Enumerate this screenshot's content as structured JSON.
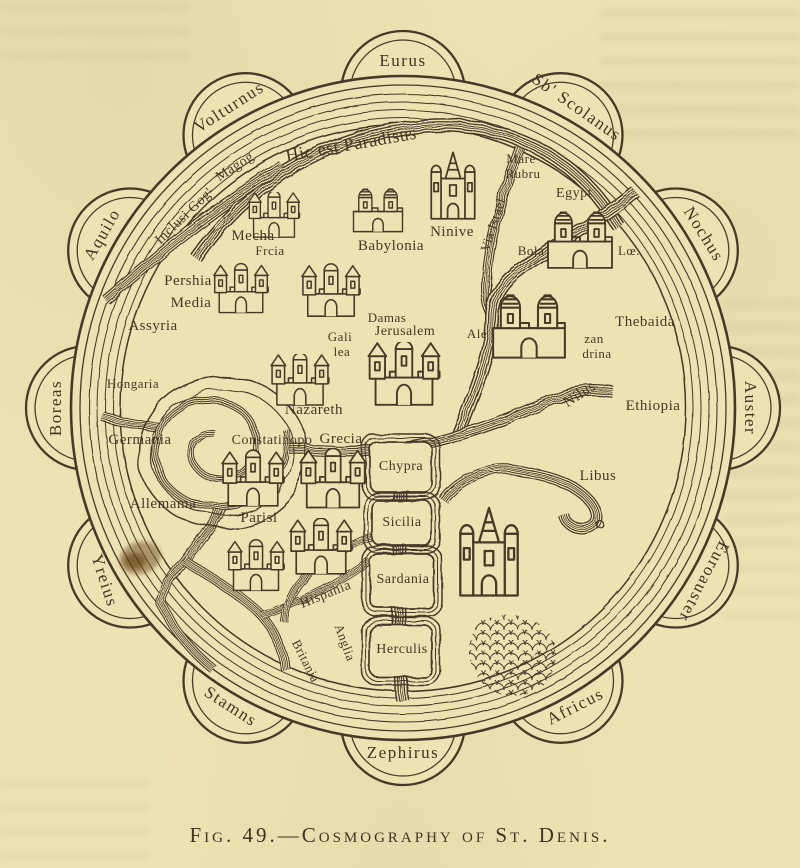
{
  "figure": {
    "caption": "Fig. 49.—Cosmography of St. Denis."
  },
  "colors": {
    "paper": "#ece3b2",
    "ink": "#46392a",
    "stain": "#6d4b1d"
  },
  "winds": [
    {
      "name": "Eurus",
      "angle": 0,
      "rot": 0
    },
    {
      "name": "Sb' Scolanus",
      "angle": 30,
      "rot": 35
    },
    {
      "name": "Nochus",
      "angle": 60,
      "rot": 58
    },
    {
      "name": "Auster",
      "angle": 90,
      "rot": 90
    },
    {
      "name": "Euroauster",
      "angle": 120,
      "rot": 118
    },
    {
      "name": "Africus",
      "angle": 150,
      "rot": -27
    },
    {
      "name": "Zephirus",
      "angle": 180,
      "rot": 0
    },
    {
      "name": "Stamns",
      "angle": 210,
      "rot": 33
    },
    {
      "name": "Yreius",
      "angle": 240,
      "rot": 72
    },
    {
      "name": "Boreas",
      "angle": 270,
      "rot": -90
    },
    {
      "name": "Aquilo",
      "angle": 300,
      "rot": -60
    },
    {
      "name": "Volturnus",
      "angle": 330,
      "rot": -33
    }
  ],
  "labels": [
    {
      "text": "Hic est Paradisus",
      "x": 352,
      "y": 150,
      "rot": -10,
      "size": 18
    },
    {
      "text": "Magog",
      "x": 237,
      "y": 170,
      "rot": -33,
      "size": 14
    },
    {
      "text": "Inclusi Gog'",
      "x": 187,
      "y": 219,
      "rot": -44,
      "size": 14
    },
    {
      "text": "Mecha",
      "x": 253,
      "y": 240,
      "rot": 0,
      "size": 15
    },
    {
      "text": "Frcia",
      "x": 270,
      "y": 255,
      "rot": 0,
      "size": 13
    },
    {
      "text": "Babylonia",
      "x": 391,
      "y": 250,
      "rot": 0,
      "size": 15
    },
    {
      "text": "Ninive",
      "x": 452,
      "y": 236,
      "rot": 0,
      "size": 15
    },
    {
      "text": "Pershia",
      "x": 188,
      "y": 285,
      "rot": 0,
      "size": 15
    },
    {
      "text": "Media",
      "x": 191,
      "y": 307,
      "rot": 0,
      "size": 15
    },
    {
      "text": "Assyria",
      "x": 153,
      "y": 330,
      "rot": 0,
      "size": 15
    },
    {
      "text": "Hongaria",
      "x": 133,
      "y": 388,
      "rot": 0,
      "size": 13
    },
    {
      "text": "Germania",
      "x": 140,
      "y": 444,
      "rot": 0,
      "size": 15
    },
    {
      "text": "Allemama",
      "x": 163,
      "y": 508,
      "rot": 0,
      "size": 15
    },
    {
      "text": "Damas",
      "x": 387,
      "y": 322,
      "rot": 0,
      "size": 13
    },
    {
      "text": "Jerusalem",
      "x": 405,
      "y": 335,
      "rot": 0,
      "size": 14
    },
    {
      "text": "Gali",
      "x": 340,
      "y": 341,
      "rot": 0,
      "size": 13
    },
    {
      "text": "lea",
      "x": 342,
      "y": 356,
      "rot": 0,
      "size": 13
    },
    {
      "text": "Nazareth",
      "x": 314,
      "y": 414,
      "rot": 0,
      "size": 15
    },
    {
      "text": "Mare",
      "x": 521,
      "y": 163,
      "rot": 0,
      "size": 13
    },
    {
      "text": "Rubru",
      "x": 523,
      "y": 178,
      "rot": 0,
      "size": 13
    },
    {
      "text": "Via Israel",
      "x": 497,
      "y": 226,
      "rot": -72,
      "size": 13
    },
    {
      "text": "Egypt",
      "x": 574,
      "y": 197,
      "rot": 0,
      "size": 14
    },
    {
      "text": "Bola",
      "x": 531,
      "y": 255,
      "rot": 0,
      "size": 13
    },
    {
      "text": "Lœ.",
      "x": 629,
      "y": 255,
      "rot": 0,
      "size": 13
    },
    {
      "text": "Ale",
      "x": 477,
      "y": 338,
      "rot": 0,
      "size": 13
    },
    {
      "text": "zan",
      "x": 594,
      "y": 343,
      "rot": 0,
      "size": 13
    },
    {
      "text": "drina",
      "x": 597,
      "y": 358,
      "rot": 0,
      "size": 13
    },
    {
      "text": "Thebaida",
      "x": 645,
      "y": 326,
      "rot": 0,
      "size": 15
    },
    {
      "text": "Nilus",
      "x": 582,
      "y": 398,
      "rot": -33,
      "size": 15
    },
    {
      "text": "Ethiopia",
      "x": 653,
      "y": 410,
      "rot": 0,
      "size": 15
    },
    {
      "text": "Libus",
      "x": 598,
      "y": 480,
      "rot": 0,
      "size": 15
    },
    {
      "text": "Constatinopo",
      "x": 272,
      "y": 444,
      "rot": 0,
      "size": 14
    },
    {
      "text": "Grecia",
      "x": 341,
      "y": 443,
      "rot": 0,
      "size": 15
    },
    {
      "text": "Chypra",
      "x": 401,
      "y": 470,
      "rot": 0,
      "size": 14
    },
    {
      "text": "Parisi",
      "x": 259,
      "y": 522,
      "rot": 0,
      "size": 15
    },
    {
      "text": "Sicilia",
      "x": 402,
      "y": 526,
      "rot": 0,
      "size": 14
    },
    {
      "text": "Sardania",
      "x": 403,
      "y": 583,
      "rot": 0,
      "size": 14
    },
    {
      "text": "Herculis",
      "x": 402,
      "y": 653,
      "rot": 0,
      "size": 14
    },
    {
      "text": "Hispania",
      "x": 327,
      "y": 598,
      "rot": -22,
      "size": 14
    },
    {
      "text": "Anglia",
      "x": 341,
      "y": 644,
      "rot": 70,
      "size": 13
    },
    {
      "text": "Britania",
      "x": 302,
      "y": 663,
      "rot": 63,
      "size": 13
    }
  ],
  "islands": [
    {
      "name": "chypra-island",
      "x": 370,
      "y": 442,
      "w": 62,
      "h": 50
    },
    {
      "name": "sicilia-island",
      "x": 372,
      "y": 501,
      "w": 60,
      "h": 44
    },
    {
      "name": "sardania-island",
      "x": 370,
      "y": 554,
      "w": 64,
      "h": 54
    },
    {
      "name": "herculis-island",
      "x": 370,
      "y": 625,
      "w": 62,
      "h": 52
    }
  ],
  "castles": [
    {
      "type": "castle",
      "x": 243,
      "y": 192,
      "w": 62,
      "h": 46,
      "name": "mecha-castle"
    },
    {
      "type": "castle",
      "x": 212,
      "y": 258,
      "w": 58,
      "h": 62,
      "name": "frcia-castle"
    },
    {
      "type": "dome",
      "x": 350,
      "y": 182,
      "w": 56,
      "h": 52,
      "name": "babylonia-castle"
    },
    {
      "type": "castle",
      "x": 300,
      "y": 262,
      "w": 62,
      "h": 58,
      "name": "damascus-castle"
    },
    {
      "type": "castle",
      "x": 362,
      "y": 342,
      "w": 84,
      "h": 64,
      "name": "jerusalem-castle"
    },
    {
      "type": "castle",
      "x": 268,
      "y": 354,
      "w": 64,
      "h": 52,
      "name": "nazareth-castle"
    },
    {
      "type": "church",
      "x": 428,
      "y": 144,
      "w": 50,
      "h": 82,
      "name": "ninive-church"
    },
    {
      "type": "dome",
      "x": 543,
      "y": 205,
      "w": 74,
      "h": 64,
      "name": "egypt-castle"
    },
    {
      "type": "dome",
      "x": 488,
      "y": 284,
      "w": 82,
      "h": 78,
      "name": "alexandria-castle"
    },
    {
      "type": "castle",
      "x": 220,
      "y": 448,
      "w": 66,
      "h": 62,
      "name": "constantinople-castle"
    },
    {
      "type": "castle",
      "x": 298,
      "y": 448,
      "w": 70,
      "h": 62,
      "name": "grecia-castle"
    },
    {
      "type": "castle",
      "x": 226,
      "y": 528,
      "w": 60,
      "h": 76,
      "name": "paris-castle"
    },
    {
      "type": "castle",
      "x": 288,
      "y": 518,
      "w": 66,
      "h": 58,
      "name": "hispania-castle"
    },
    {
      "type": "church",
      "x": 456,
      "y": 505,
      "w": 66,
      "h": 92,
      "name": "fez-castle"
    }
  ]
}
